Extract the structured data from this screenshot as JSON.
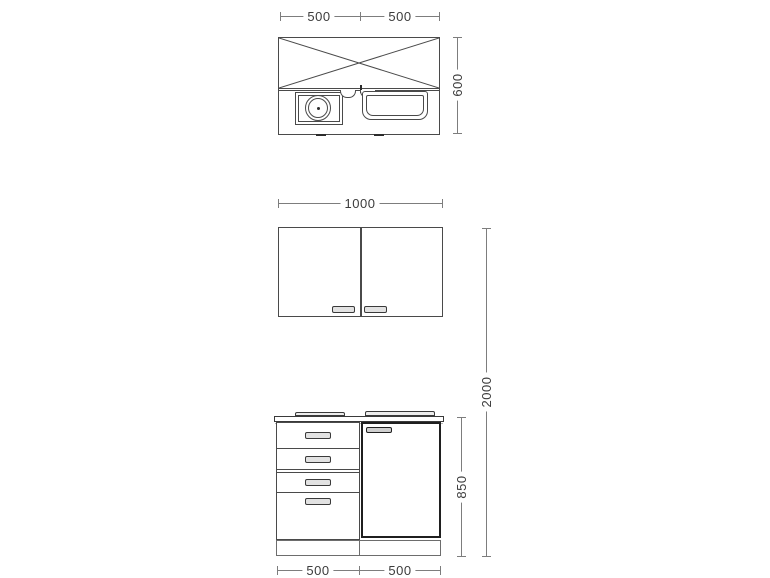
{
  "dimensions": {
    "plan_width_left": "500",
    "plan_width_right": "500",
    "plan_depth": "600",
    "wall_cabinet_width": "1000",
    "total_height": "2000",
    "base_cabinet_height": "850",
    "base_width_left": "500",
    "base_width_right": "500"
  },
  "colors": {
    "background": "#ffffff",
    "drawing_line": "#4a4a4a",
    "appliance_bold_line": "#1f1f1f",
    "dimension_line": "#7d7d7d",
    "dimension_text": "#3c3c3c",
    "handle_fill": "#e2e2e2"
  },
  "icons": {
    "cross_area": "crossed-worktop-area",
    "burner": "hob-burner-circle",
    "sink": "sink-basin",
    "taps": "faucet-arcs"
  }
}
